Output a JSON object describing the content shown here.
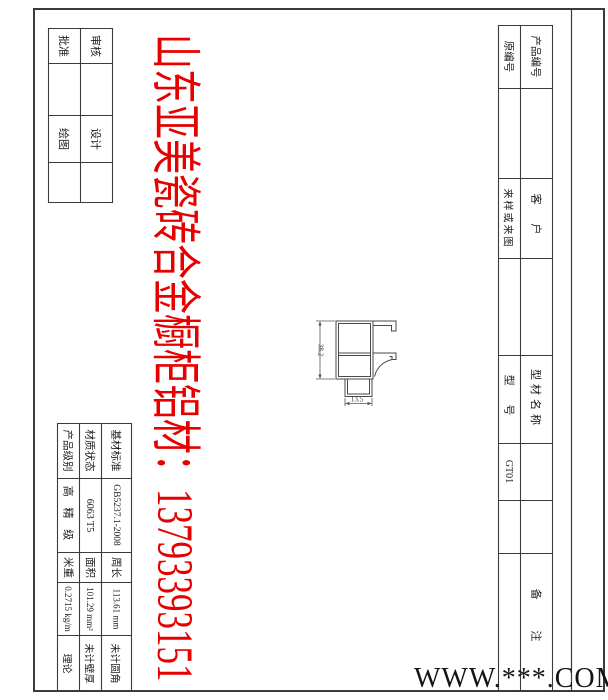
{
  "sheet": {
    "line_color": "#3b3b3b",
    "red_color": "#e60000",
    "background": "#ffffff"
  },
  "watermarks": {
    "red_text": "山东亚美瓷砖合金橱柜铝材：13793393151",
    "site": "WWW.***.COM"
  },
  "title_block_left": {
    "approve": "批准",
    "check": "审核",
    "draw": "绘图",
    "design": "设计"
  },
  "title_block_right": {
    "original_no": "原编号",
    "product_no": "产品编号",
    "sample_or_drawing": "来样或来图",
    "customer": "客  户",
    "model": "型  号",
    "profile_name": "型材名称",
    "model_value": "GT01",
    "remarks": "备  注"
  },
  "spec_table": {
    "product_grade_label": "产品级别",
    "product_grade_value": "高 精 级",
    "material_state_label": "材质状态",
    "material_state_value": "6063 T5",
    "base_standard_label": "基材标准",
    "base_standard_value": "GB5237.1-2008",
    "meter_weight_label": "米重",
    "meter_weight_value": "0.2715 kg/m",
    "meter_weight_note": "理论",
    "area_label": "面积",
    "area_value": "101.29 mm²",
    "area_note": "未计壁厚",
    "perimeter_label": "周长",
    "perimeter_value": "113.61 mm",
    "perimeter_note": "未计圆角"
  },
  "drawing": {
    "height_dim": "38.2",
    "width_dim": "13.5"
  }
}
